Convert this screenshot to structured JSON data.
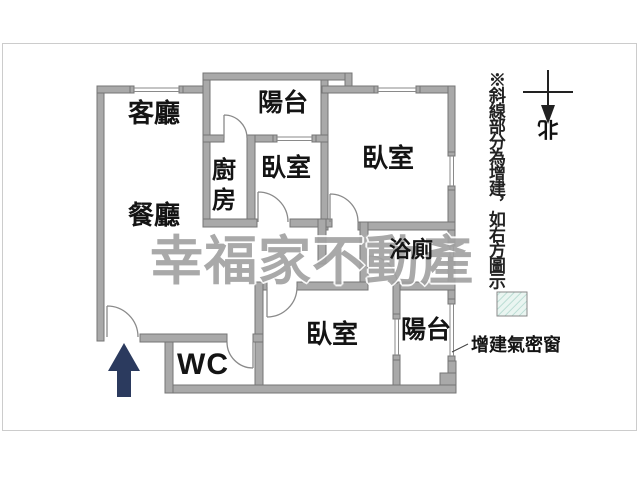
{
  "plan": {
    "watermark": "幸福家不動產",
    "rooms": {
      "living": "客廳",
      "dining": "餐廳",
      "kitchen": "廚房",
      "balcony_top": "陽台",
      "bedroom_center": "臥室",
      "bedroom_right": "臥室",
      "bedroom_bottom": "臥室",
      "bathroom": "浴廁",
      "wc": "WC",
      "balcony_bottom": "陽台"
    },
    "annotations": {
      "side_note": "※斜線部分為增建，如右方圖示",
      "window_label": "增建氣密窗",
      "compass_north": "北"
    },
    "colors": {
      "wall_fill": "#a9a9a9",
      "wall_edge": "#757575",
      "door_arc": "#8a8a8a",
      "entrance_arrow": "#2b3a5e",
      "watermark_gray": "#a2a2a2",
      "hatch_fill": "#eaf5f1",
      "hatch_line": "#a9d4c9",
      "frame_border": "#cccccc"
    }
  }
}
